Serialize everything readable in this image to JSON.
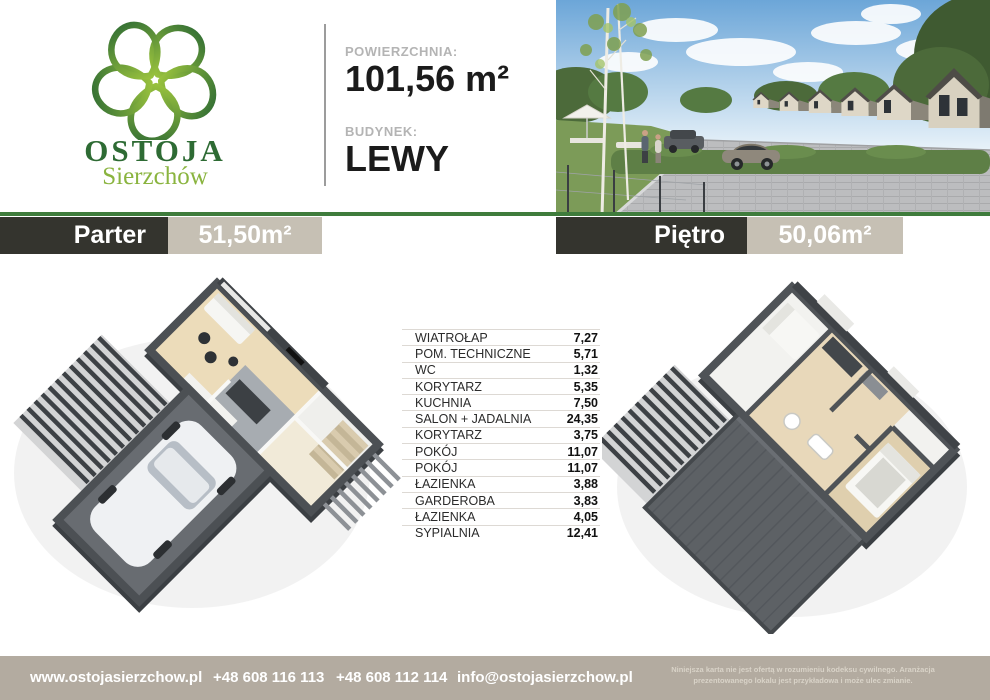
{
  "header": {
    "logo_name": "OSTOJA",
    "logo_subname": "Sierzchów",
    "area_label": "POWIERZCHNIA:",
    "area_value": "101,56 m²",
    "building_label": "BUDYNEK:",
    "building_value": "LEWY"
  },
  "banners": {
    "left": {
      "title": "Parter",
      "area": "51,50m²"
    },
    "right": {
      "title": "Piętro",
      "area": "50,06m²"
    }
  },
  "rooms": [
    {
      "name": "WIATROŁAP",
      "area": "7,27"
    },
    {
      "name": "POM. TECHNICZNE",
      "area": "5,71"
    },
    {
      "name": "WC",
      "area": "1,32"
    },
    {
      "name": "KORYTARZ",
      "area": "5,35"
    },
    {
      "name": "KUCHNIA",
      "area": "7,50"
    },
    {
      "name": "SALON + JADALNIA",
      "area": "24,35"
    },
    {
      "name": "KORYTARZ",
      "area": "3,75"
    },
    {
      "name": "POKÓJ",
      "area": "11,07"
    },
    {
      "name": "POKÓJ",
      "area": "11,07"
    },
    {
      "name": "ŁAZIENKA",
      "area": "3,88"
    },
    {
      "name": "GARDEROBA",
      "area": "3,83"
    },
    {
      "name": "ŁAZIENKA",
      "area": "4,05"
    },
    {
      "name": "SYPIALNIA",
      "area": "12,41"
    }
  ],
  "footer": {
    "website": "www.ostojasierzchow.pl",
    "phone1": "+48 608 116 113",
    "phone2": "+48 608 112 114",
    "email": "info@ostojasierzchow.pl",
    "disclaimer_line1": "Niniejsza karta nie jest ofertą w rozumieniu kodeksu cywilnego. Aranżacja",
    "disclaimer_line2": "prezentowanego lokalu jest przykładowa i może ulec zmianie."
  },
  "colors": {
    "accent_green": "#3f7c3c",
    "dark": "#34342e",
    "banner_beige": "#c6c0b4",
    "footer_beige": "#b3aba0",
    "logo_dark": "#2e6b34",
    "logo_light": "#8ab43f",
    "label_gray": "#b4b4b4",
    "text": "#1b1b1b"
  }
}
